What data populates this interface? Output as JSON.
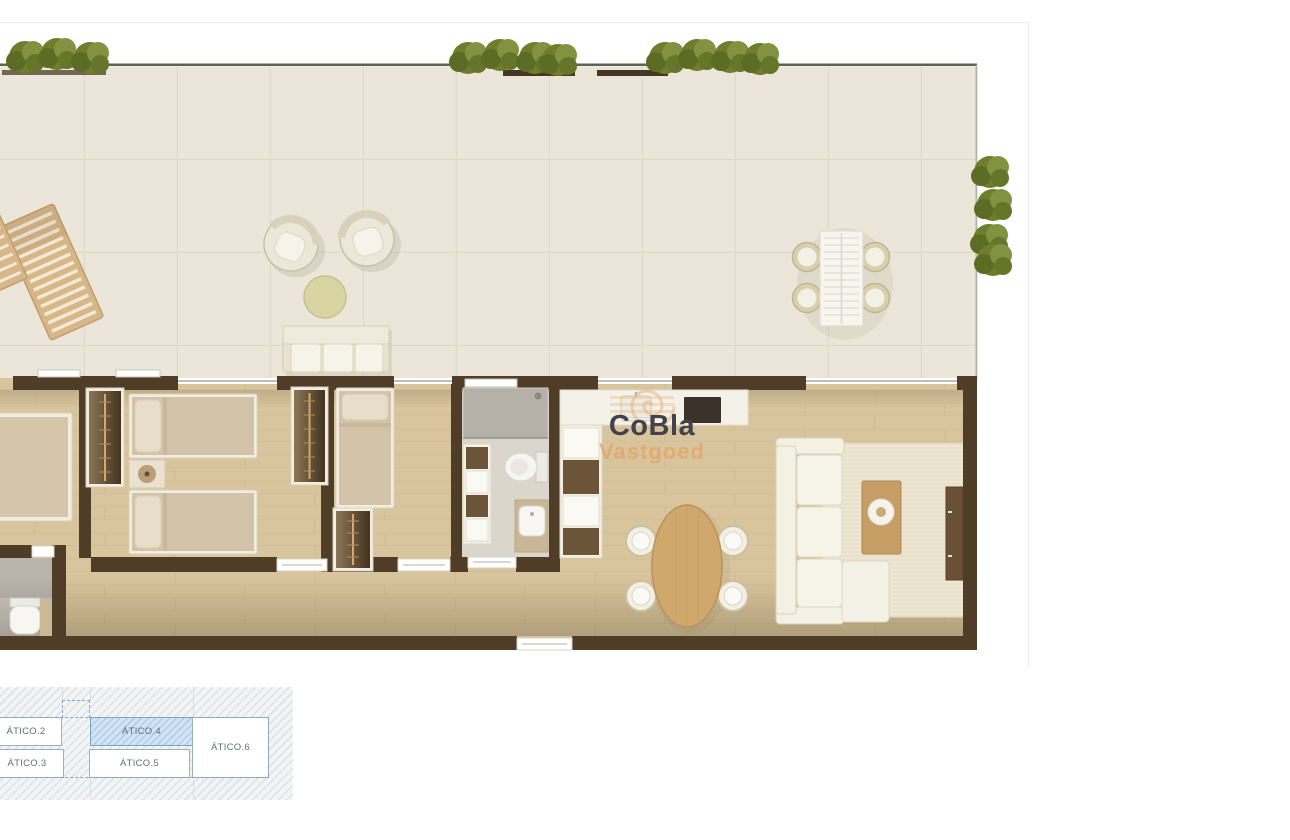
{
  "watermark": {
    "brand": "CoBla",
    "subtitle": "Vastgoed",
    "brand_color": "#42424a",
    "subtitle_color": "#e4a264"
  },
  "keyplan": {
    "units": [
      {
        "label": "ÁTICO.2",
        "highlighted": false
      },
      {
        "label": "ÁTICO.3",
        "highlighted": false
      },
      {
        "label": "ÁTICO.4",
        "highlighted": true
      },
      {
        "label": "ÁTICO.5",
        "highlighted": false
      },
      {
        "label": "ÁTICO.6",
        "highlighted": false
      }
    ],
    "highlight_fill": "#cfe3f4",
    "box_border_color": "#9cb0c2",
    "dashed_outline_color": "#8aa4c2",
    "label_color": "#5c7083"
  },
  "palette": {
    "wall": "#4f3d27",
    "wood_floor": "#d9c59d",
    "terrace_tile": "#ebe6d9",
    "plant_green": "#74832f",
    "rug": "#e9e1cb",
    "kitchen_counter": "#f4f1e9",
    "cooktop": "#3b332b",
    "bathroom_floor": "#dad6cc"
  },
  "floorplan": {
    "rooms": [
      "terrace",
      "bedroom-1",
      "bedroom-2-twin",
      "bedroom-3",
      "bathroom",
      "guest-wc",
      "kitchen",
      "dining-area",
      "living-room",
      "hallway"
    ],
    "furniture": [
      "sun-lounger",
      "armchair",
      "armchair",
      "round-side-table",
      "outdoor-sofa",
      "outdoor-dining-table",
      "outdoor-chairs-x4",
      "planter-hedges-x4",
      "wardrobes-x3",
      "single-beds-x4",
      "nightstand-with-lamp",
      "shower",
      "toilets-x2",
      "washbasins-x2",
      "kitchen-counter-with-sink-and-cooktop",
      "open-shelving-x2",
      "oval-dining-table",
      "dining-chairs-x4",
      "sectional-sofa",
      "area-rug",
      "coffee-table",
      "tv-sideboard"
    ]
  }
}
